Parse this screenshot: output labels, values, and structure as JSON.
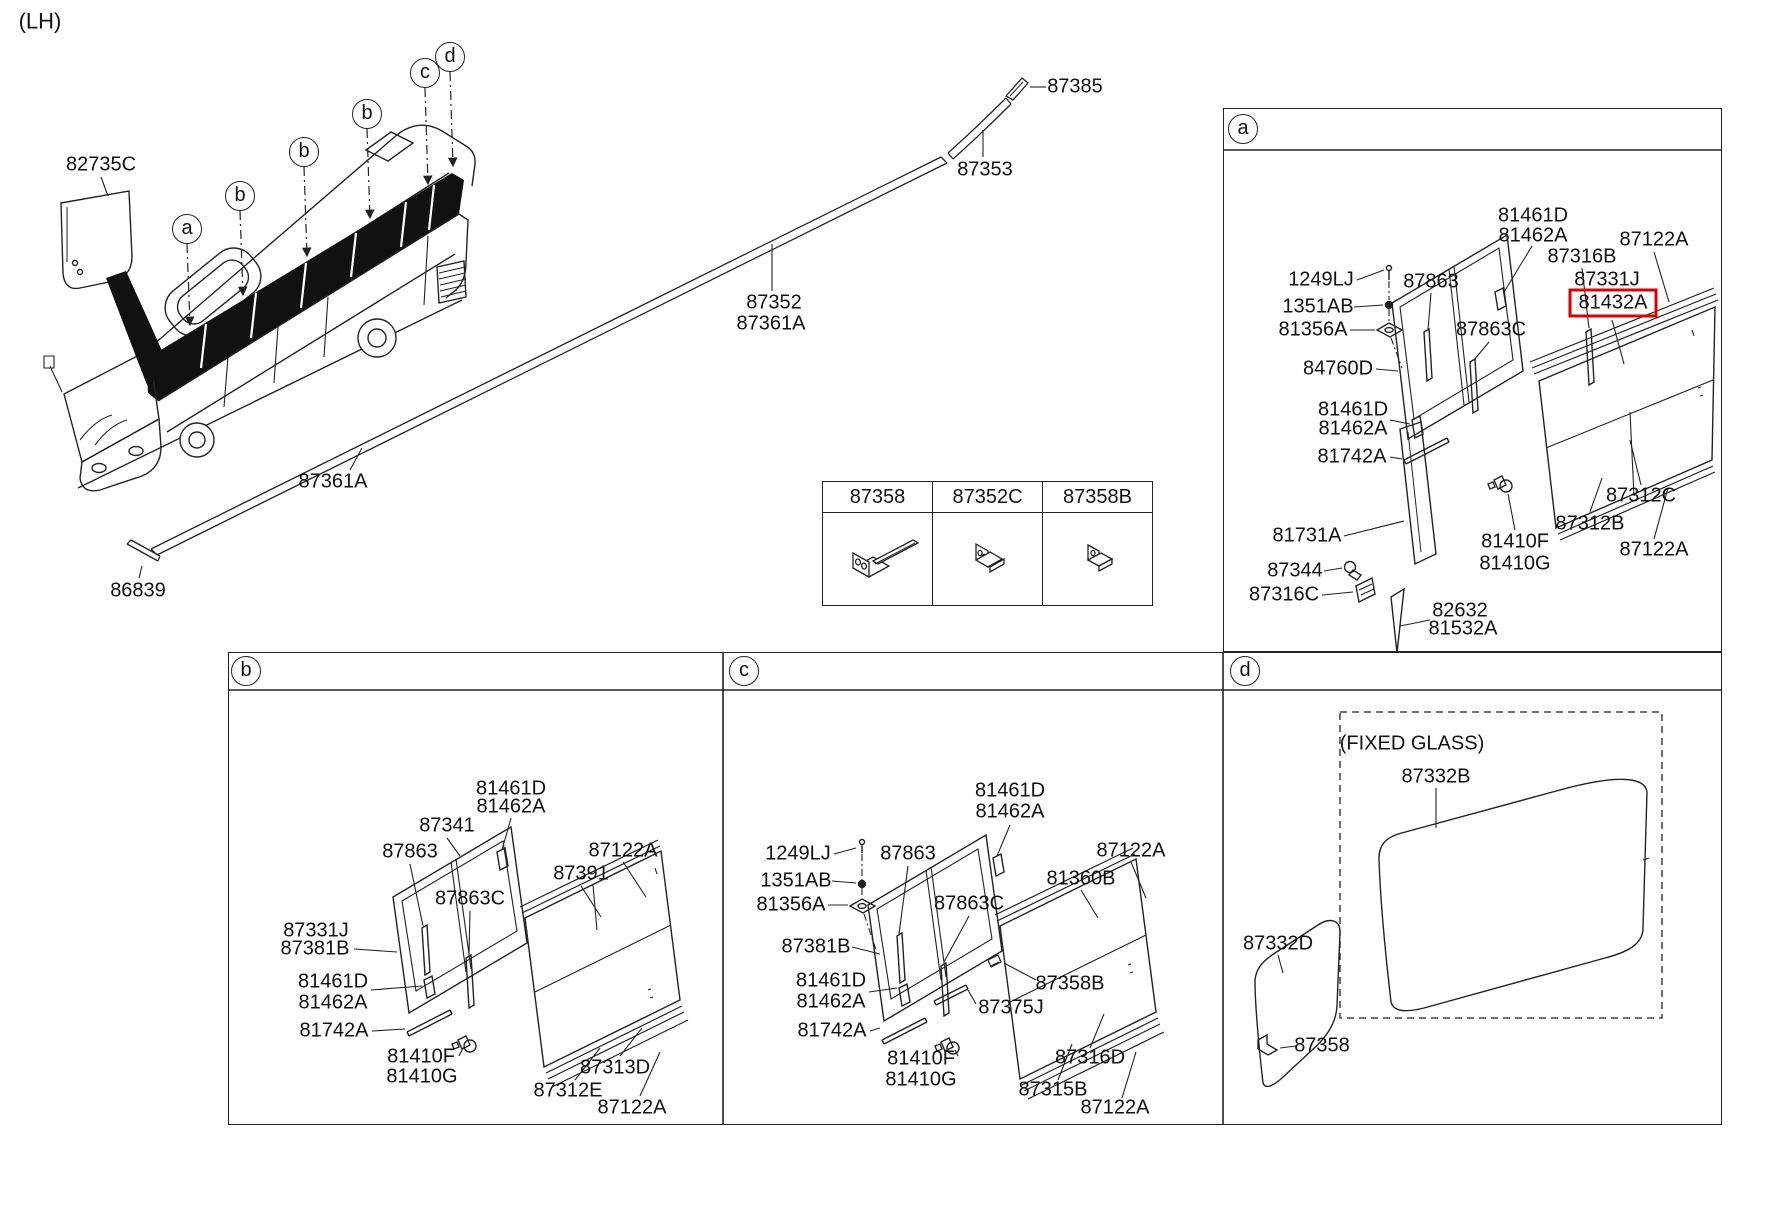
{
  "side_label": "(LH)",
  "colors": {
    "ink": "#222222",
    "highlight_red": "#dd0000"
  },
  "bracket_table": {
    "columns": [
      "87358",
      "87352C",
      "87358B"
    ]
  },
  "regions": [
    {
      "name": "overview",
      "labels": [
        {
          "t": "(LH)",
          "x": 40,
          "y": 21,
          "fs": 22,
          "n": "side-label"
        },
        {
          "t": "82735C",
          "x": 101,
          "y": 165
        },
        {
          "t": "87385",
          "x": 1075,
          "y": 87
        },
        {
          "t": "87353",
          "x": 985,
          "y": 170
        },
        {
          "t": "87352",
          "x": 774,
          "y": 303
        },
        {
          "t": "87361A",
          "x": 771,
          "y": 324
        },
        {
          "t": "87361A",
          "x": 333,
          "y": 482
        },
        {
          "t": "86839",
          "x": 138,
          "y": 591
        },
        {
          "t": "a",
          "x": 187,
          "y": 229,
          "kind": "circle",
          "n": "callout-a"
        },
        {
          "t": "b",
          "x": 240,
          "y": 196,
          "kind": "circle",
          "n": "callout-b"
        },
        {
          "t": "b",
          "x": 304,
          "y": 152,
          "kind": "circle",
          "n": "callout-b"
        },
        {
          "t": "b",
          "x": 367,
          "y": 114,
          "kind": "circle",
          "n": "callout-b"
        },
        {
          "t": "c",
          "x": 425,
          "y": 73,
          "kind": "circle",
          "n": "callout-c"
        },
        {
          "t": "d",
          "x": 450,
          "y": 57,
          "kind": "circle",
          "n": "callout-d"
        }
      ]
    },
    {
      "name": "panel-a",
      "labels": [
        {
          "t": "a",
          "x": 1243,
          "y": 129,
          "kind": "circle",
          "n": "panel-a-letter"
        },
        {
          "t": "81461D",
          "x": 1533,
          "y": 216
        },
        {
          "t": "81462A",
          "x": 1533,
          "y": 236
        },
        {
          "t": "87122A",
          "x": 1654,
          "y": 240
        },
        {
          "t": "87316B",
          "x": 1582,
          "y": 257
        },
        {
          "t": "87331J",
          "x": 1607,
          "y": 280
        },
        {
          "t": "81432A",
          "x": 1613,
          "y": 303,
          "kind": "boxed",
          "n": "highlighted-part-81432A"
        },
        {
          "t": "1249LJ",
          "x": 1321,
          "y": 280
        },
        {
          "t": "1351AB",
          "x": 1318,
          "y": 307
        },
        {
          "t": "81356A",
          "x": 1313,
          "y": 330
        },
        {
          "t": "87863",
          "x": 1431,
          "y": 282
        },
        {
          "t": "87863C",
          "x": 1491,
          "y": 330
        },
        {
          "t": "84760D",
          "x": 1338,
          "y": 369
        },
        {
          "t": "81461D",
          "x": 1353,
          "y": 410
        },
        {
          "t": "81462A",
          "x": 1353,
          "y": 429
        },
        {
          "t": "81742A",
          "x": 1352,
          "y": 457
        },
        {
          "t": "81731A",
          "x": 1307,
          "y": 536
        },
        {
          "t": "87344",
          "x": 1295,
          "y": 571
        },
        {
          "t": "87316C",
          "x": 1284,
          "y": 595
        },
        {
          "t": "82632",
          "x": 1460,
          "y": 611
        },
        {
          "t": "81532A",
          "x": 1463,
          "y": 629
        },
        {
          "t": "81410F",
          "x": 1515,
          "y": 542
        },
        {
          "t": "81410G",
          "x": 1515,
          "y": 564
        },
        {
          "t": "87312B",
          "x": 1590,
          "y": 524
        },
        {
          "t": "87312C",
          "x": 1641,
          "y": 496
        },
        {
          "t": "87122A",
          "x": 1654,
          "y": 550
        }
      ]
    },
    {
      "name": "panel-b",
      "labels": [
        {
          "t": "b",
          "x": 246,
          "y": 671,
          "kind": "circle",
          "n": "panel-b-letter"
        },
        {
          "t": "81461D",
          "x": 511,
          "y": 789
        },
        {
          "t": "81462A",
          "x": 511,
          "y": 807
        },
        {
          "t": "87341",
          "x": 447,
          "y": 826
        },
        {
          "t": "87863",
          "x": 410,
          "y": 852
        },
        {
          "t": "87122A",
          "x": 623,
          "y": 851
        },
        {
          "t": "87391",
          "x": 581,
          "y": 874
        },
        {
          "t": "87863C",
          "x": 470,
          "y": 899
        },
        {
          "t": "87331J",
          "x": 316,
          "y": 931
        },
        {
          "t": "87381B",
          "x": 315,
          "y": 949
        },
        {
          "t": "81461D",
          "x": 333,
          "y": 982
        },
        {
          "t": "81462A",
          "x": 333,
          "y": 1003
        },
        {
          "t": "81742A",
          "x": 334,
          "y": 1031
        },
        {
          "t": "81410F",
          "x": 421,
          "y": 1057
        },
        {
          "t": "81410G",
          "x": 422,
          "y": 1077
        },
        {
          "t": "87313D",
          "x": 615,
          "y": 1068
        },
        {
          "t": "87312E",
          "x": 568,
          "y": 1091
        },
        {
          "t": "87122A",
          "x": 632,
          "y": 1108
        }
      ]
    },
    {
      "name": "panel-c",
      "labels": [
        {
          "t": "c",
          "x": 744,
          "y": 671,
          "kind": "circle",
          "n": "panel-c-letter"
        },
        {
          "t": "81461D",
          "x": 1010,
          "y": 791
        },
        {
          "t": "81462A",
          "x": 1010,
          "y": 812
        },
        {
          "t": "1249LJ",
          "x": 798,
          "y": 854
        },
        {
          "t": "1351AB",
          "x": 796,
          "y": 881
        },
        {
          "t": "81356A",
          "x": 791,
          "y": 905
        },
        {
          "t": "87863",
          "x": 908,
          "y": 854
        },
        {
          "t": "87863C",
          "x": 969,
          "y": 904
        },
        {
          "t": "87381B",
          "x": 816,
          "y": 947
        },
        {
          "t": "81461D",
          "x": 831,
          "y": 981
        },
        {
          "t": "81462A",
          "x": 831,
          "y": 1002
        },
        {
          "t": "81742A",
          "x": 832,
          "y": 1031
        },
        {
          "t": "81410F",
          "x": 921,
          "y": 1059
        },
        {
          "t": "81410G",
          "x": 921,
          "y": 1080
        },
        {
          "t": "87358B",
          "x": 1070,
          "y": 984
        },
        {
          "t": "87375J",
          "x": 1011,
          "y": 1008
        },
        {
          "t": "87122A",
          "x": 1131,
          "y": 851
        },
        {
          "t": "81360B",
          "x": 1081,
          "y": 879
        },
        {
          "t": "87316D",
          "x": 1090,
          "y": 1058
        },
        {
          "t": "87315B",
          "x": 1053,
          "y": 1090
        },
        {
          "t": "87122A",
          "x": 1115,
          "y": 1108
        }
      ]
    },
    {
      "name": "panel-d",
      "labels": [
        {
          "t": "d",
          "x": 1245,
          "y": 671,
          "kind": "circle",
          "n": "panel-d-letter"
        },
        {
          "t": "(FIXED GLASS)",
          "x": 1412,
          "y": 744,
          "n": "fixed-glass-caption"
        },
        {
          "t": "87332B",
          "x": 1436,
          "y": 777
        },
        {
          "t": "87332D",
          "x": 1278,
          "y": 944
        },
        {
          "t": "87358",
          "x": 1322,
          "y": 1046
        }
      ]
    }
  ]
}
